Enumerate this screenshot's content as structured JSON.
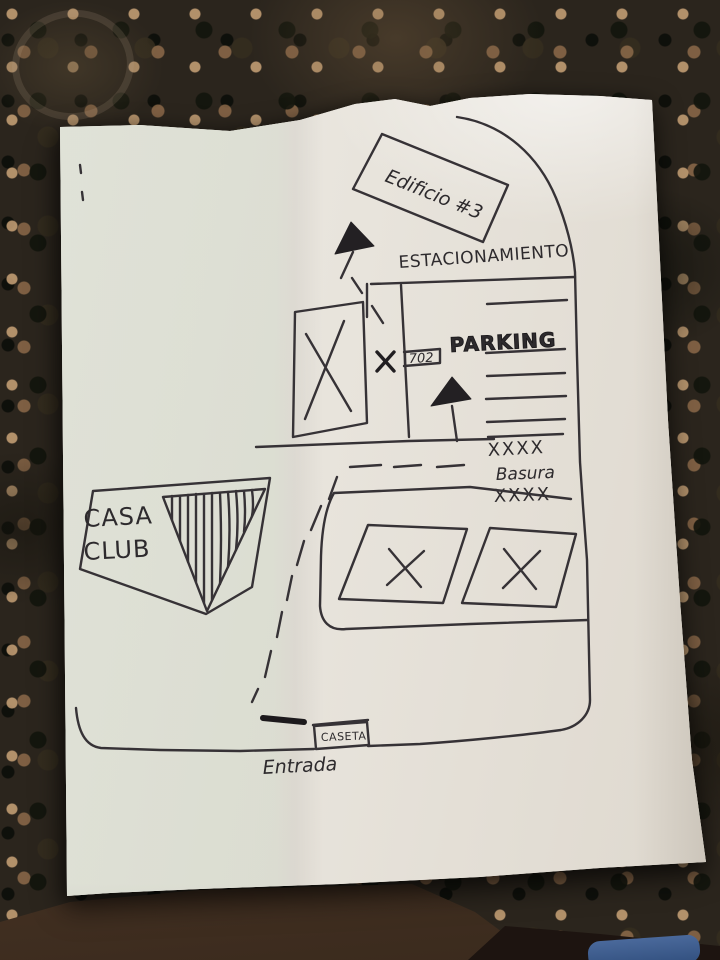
{
  "photo": {
    "surface": "granite-countertop",
    "colors": {
      "ink": "#363236",
      "paper": "#eae6df",
      "granite": "#2b251d",
      "floor": "#5a4230",
      "denim": "#44618f"
    }
  },
  "map": {
    "building_label": "Edificio #3",
    "parking_area_label": "ESTACIONAMIENTO",
    "parking_label": "PARKING",
    "spot_number": "702",
    "trash_row_top": "XXXX",
    "trash_label": "Basura",
    "trash_row_bottom": "XXXX",
    "clubhouse_line1": "CASA",
    "clubhouse_line2": "CLUB",
    "gatehouse_label": "CASETA",
    "entrance_label": "Entrada"
  }
}
